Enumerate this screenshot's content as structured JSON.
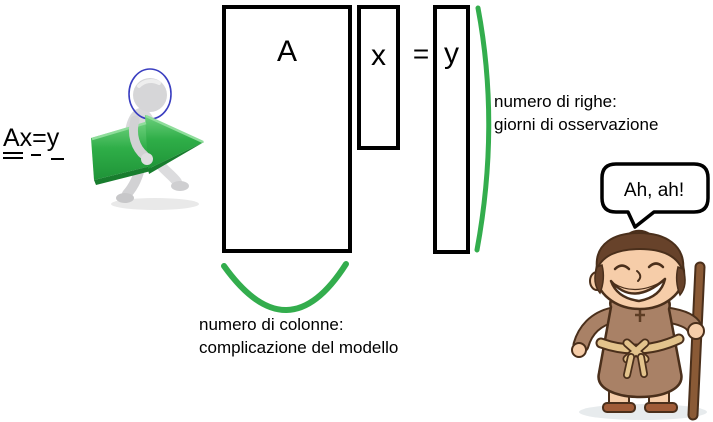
{
  "diagram": {
    "title_context": "matrix equation Ax=y illustration",
    "equation_annotation": "Ax=y",
    "matrix_a_label": "A",
    "vector_x_label": "x",
    "equals_sign": "=",
    "vector_y_label": "y",
    "rows_annotation_line1": "numero di righe:",
    "rows_annotation_line2": "giorni di osservazione",
    "columns_annotation_line1": "numero di colonne:",
    "columns_annotation_line2": "complicazione del modello",
    "speech_bubble_text": "Ah, ah!"
  },
  "colors": {
    "annotation_green": "#33ad4d",
    "arrow_green_main": "#2fae48",
    "arrow_green_light": "#6ed17e",
    "arrow_green_dark": "#187d2e",
    "head_circle_blue": "#3a3ec0",
    "outline_black": "#000000",
    "figure_gray": "#d6d6d8",
    "monk_robe_brown": "#a98166",
    "monk_hair_brown": "#67422a",
    "monk_skin": "#f6cda9",
    "rope_belt_tan": "#e3c38c",
    "staff_brown": "#8a5a36",
    "shadow_gray": "#e7e7e7"
  }
}
